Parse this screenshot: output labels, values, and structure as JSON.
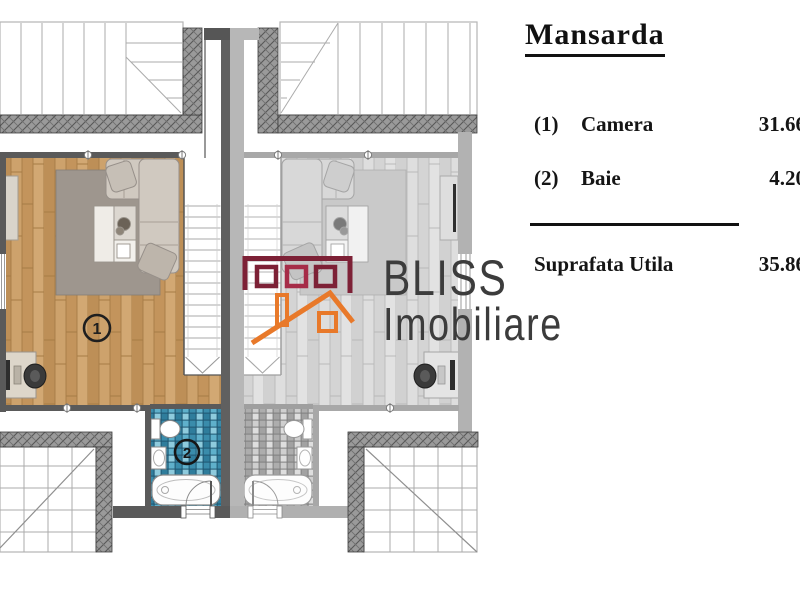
{
  "panel": {
    "title": "Mansarda",
    "rows": [
      {
        "num": "(1)",
        "label": "Camera",
        "value": "31.66"
      },
      {
        "num": "(2)",
        "label": "Baie",
        "value": "4.20"
      }
    ],
    "total_label": "Suprafata Utila",
    "total_value": "35.86"
  },
  "logo": {
    "name": "BLISS",
    "subname": "Imobiliare",
    "maroon": "#7d2136",
    "crimson": "#a62c48",
    "orange": "#e8792a"
  },
  "plan": {
    "room1_label": "1",
    "room2_label": "2",
    "colors": {
      "wood_floor": "#c79a62",
      "gray_floor": "#d8d8d8",
      "tile_blue": "#3a8cab",
      "tile_gray": "#b0b0b0",
      "wall_dark": "#5a5a5a",
      "wall_light": "#b2b2b2",
      "hatch_wall": "#9a9a9a"
    }
  }
}
